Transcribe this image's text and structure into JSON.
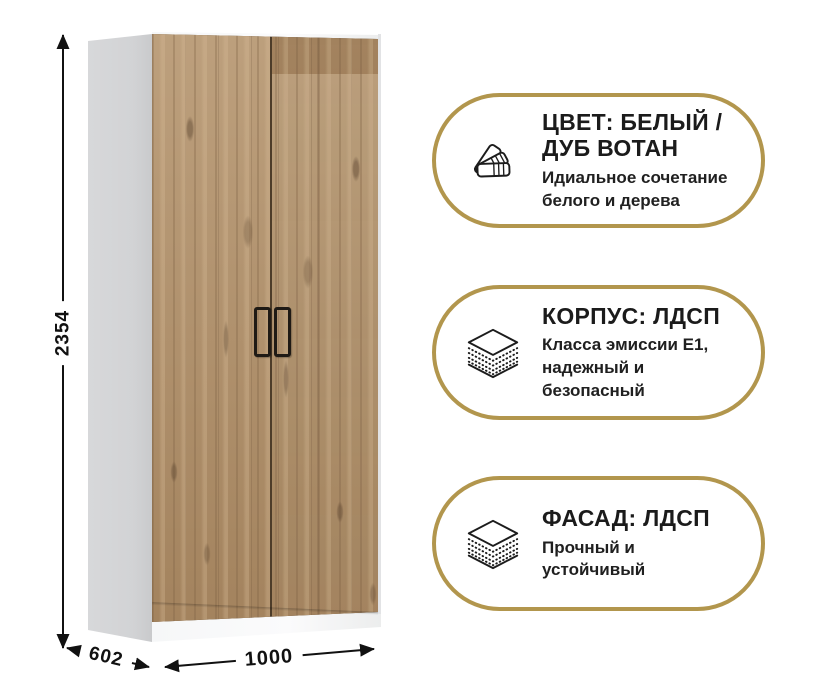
{
  "wardrobe": {
    "dimensions": {
      "height_mm": "2354",
      "depth_mm": "602",
      "width_mm": "1000"
    },
    "colors": {
      "carcass_white": "#f7f8f9",
      "side_panel_gray": "#d2d3d5",
      "wood_base": "#b08e66",
      "handle_black": "#1f1a15"
    }
  },
  "badges": [
    {
      "icon": "color-swatch-fan",
      "title_lines": [
        "ЦВЕТ: БЕЛЫЙ /",
        "ДУБ ВОТАН"
      ],
      "subtitle_lines": [
        "Идиальное сочетание",
        "белого и дерева"
      ]
    },
    {
      "icon": "laminated-board-layers",
      "title_lines": [
        "КОРПУС: ЛДСП"
      ],
      "subtitle_lines": [
        "Класса эмиссии Е1,",
        "надежный и",
        "безопасный"
      ]
    },
    {
      "icon": "laminated-board-layers",
      "title_lines": [
        "ФАСАД: ЛДСП"
      ],
      "subtitle_lines": [
        "Прочный и",
        "устойчивый"
      ]
    }
  ],
  "theme": {
    "accent_gold": "#b2964d",
    "text_dark": "#1c1c1c",
    "background": "#ffffff"
  }
}
